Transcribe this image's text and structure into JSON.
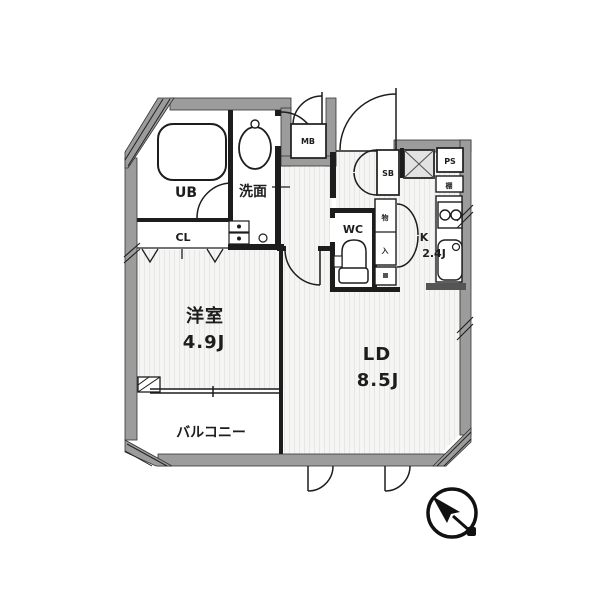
{
  "plan_type": "apartment-floor-plan",
  "rooms": {
    "living_dining": {
      "label": "LD",
      "size": "8.5J"
    },
    "western_room": {
      "label": "洋室",
      "size": "4.9J"
    },
    "kitchen": {
      "label": "K",
      "size": "2.4J"
    },
    "balcony": {
      "label": "バルコニー"
    },
    "unit_bath": {
      "label": "UB"
    },
    "washroom": {
      "label": "洗面"
    },
    "toilet": {
      "label": "WC"
    },
    "closet": {
      "label": "CL"
    },
    "shoe_box": {
      "label": "SB"
    },
    "pipe_space": {
      "label": "PS"
    },
    "meter_box": {
      "label": "MB"
    },
    "shelf": {
      "label": "棚"
    },
    "storage_cabinet": {
      "label_top": "物",
      "label_bottom": "入"
    }
  },
  "icons": {
    "north_arrow": "compass-needle-icon",
    "bathtub": "bathtub-shape",
    "washbasin": "oval-basin-shape",
    "toilet": "toilet-shape",
    "stove": "two-burner-stove-shape",
    "sink": "kitchen-sink-shape"
  },
  "colors": {
    "wall": "#9c9c9c",
    "line": "#1d1d1d",
    "floor_light": "#f5f5f4",
    "floor_stripe": "#e6e6e6",
    "hatch_fill": "#e2e2e2"
  }
}
